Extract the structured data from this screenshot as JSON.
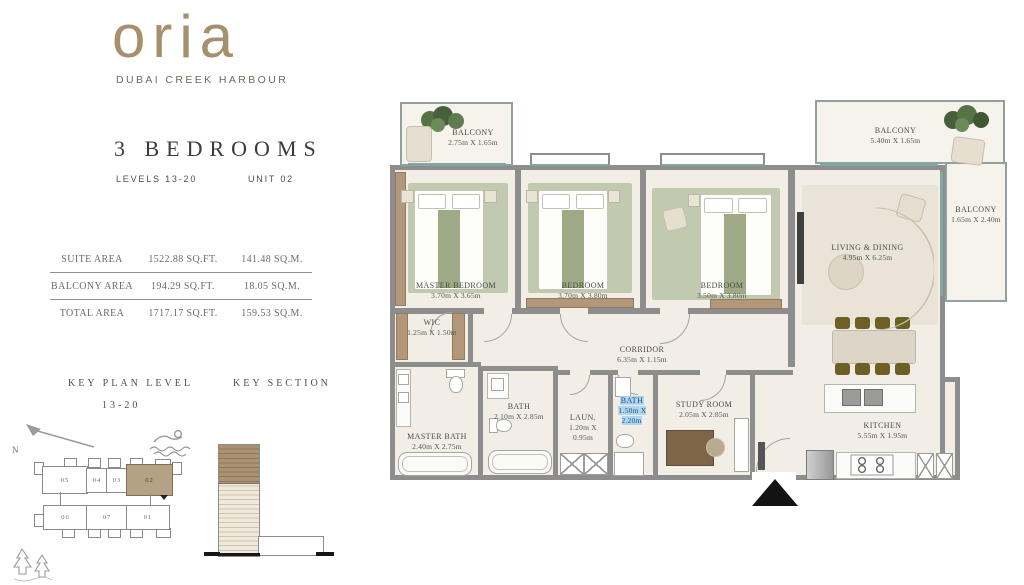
{
  "brand": {
    "logo": "oria",
    "tagline": "DUBAI CREEK HARBOUR"
  },
  "header": {
    "title": "3 BEDROOMS",
    "levels_label": "LEVELS 13-20",
    "unit_label": "UNIT 02"
  },
  "area_table": {
    "rows": [
      {
        "label": "SUITE AREA",
        "sqft": "1522.88 SQ.FT.",
        "sqm": "141.48 SQ.M."
      },
      {
        "label": "BALCONY AREA",
        "sqft": "194.29 SQ.FT.",
        "sqm": "18.05 SQ.M."
      },
      {
        "label": "TOTAL AREA",
        "sqft": "1717.17 SQ.FT.",
        "sqm": "159.53 SQ.M."
      }
    ]
  },
  "key_plan": {
    "title": "KEY PLAN LEVEL",
    "subtitle": "13-20",
    "north_label": "N",
    "units_top": [
      "05",
      "04",
      "03",
      "02"
    ],
    "units_bottom": [
      "06",
      "07",
      "01"
    ],
    "highlighted_unit": "02"
  },
  "key_section": {
    "title": "KEY SECTION"
  },
  "plan": {
    "rooms": {
      "balcony_left": {
        "name": "BALCONY",
        "dims": "2.75m X 1.65m"
      },
      "master_bedroom": {
        "name": "MASTER BEDROOM",
        "dims": "3.70m X 3.65m"
      },
      "bedroom2": {
        "name": "BEDROOM",
        "dims": "3.70m X 3.80m"
      },
      "bedroom3": {
        "name": "BEDROOM",
        "dims": "3.50m X 3.80m"
      },
      "living_dining": {
        "name": "LIVING & DINING",
        "dims": "4.95m X 6.25m"
      },
      "balcony_top": {
        "name": "BALCONY",
        "dims": "5.40m X 1.65m"
      },
      "balcony_right": {
        "name": "BALCONY",
        "dims": "1.65m X 2.40m"
      },
      "wic": {
        "name": "WIC",
        "dims": "1.25m X 1.50m"
      },
      "corridor": {
        "name": "CORRIDOR",
        "dims": "6.35m X 1.15m"
      },
      "master_bath": {
        "name": "MASTER BATH",
        "dims": "2.40m X 2.75m"
      },
      "bath1": {
        "name": "BATH",
        "dims": "2.10m X 2.85m"
      },
      "laundry": {
        "name": "LAUN.",
        "dims": "1.20m X 0.95m"
      },
      "bath2": {
        "name": "BATH",
        "dims": "1.50m X 2.20m"
      },
      "study": {
        "name": "STUDY ROOM",
        "dims": "2.05m X 2.85m"
      },
      "kitchen": {
        "name": "KITCHEN",
        "dims": "5.55m X 1.95m"
      }
    }
  },
  "colors": {
    "brand_tan": "#a6906d",
    "unit_highlight": "#b5a284",
    "wall_gray": "#8d8d8d",
    "rug_sage": "#c1c9ae",
    "selection_blue": "#aed6ec"
  }
}
